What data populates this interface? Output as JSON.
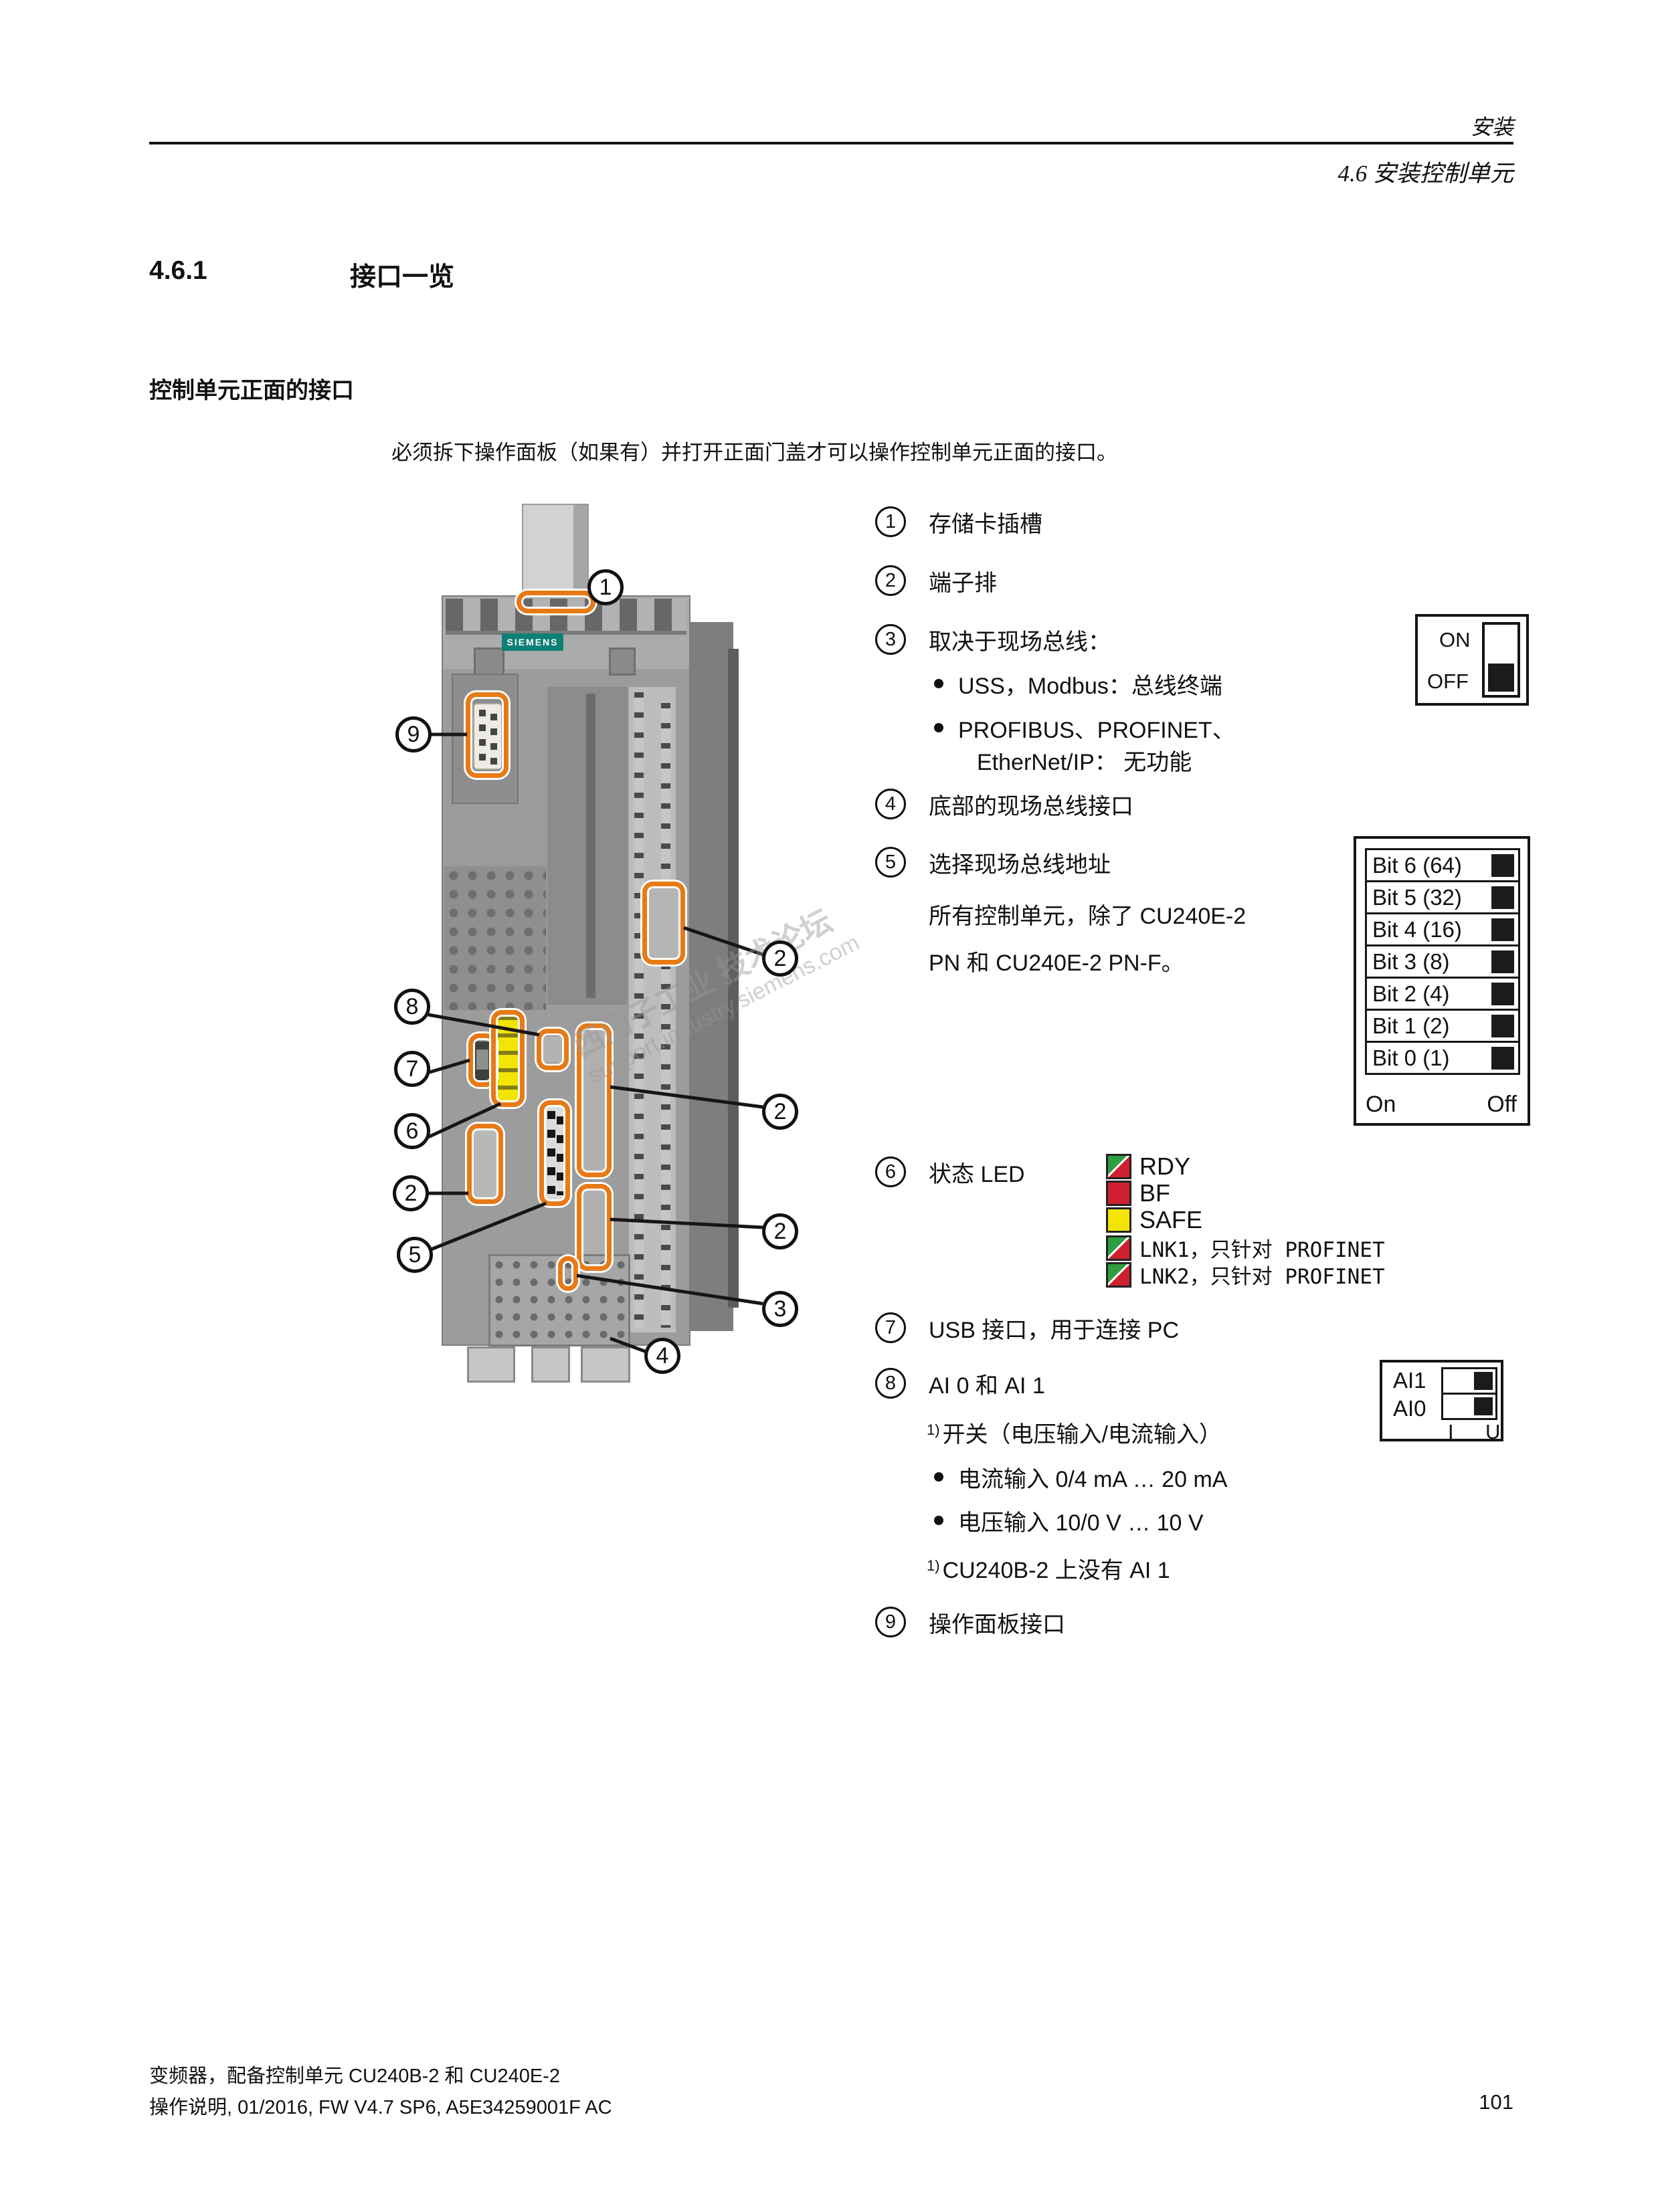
{
  "colors": {
    "accent_orange": "#e87a16",
    "siemens_teal": "#0d8074",
    "led_green": "#2f9e41",
    "led_red": "#cf2030",
    "led_yellow": "#f3e404"
  },
  "header": {
    "chapter": "安装",
    "section": "4.6 安装控制单元"
  },
  "section": {
    "number": "4.6.1",
    "title": "接口一览",
    "subheading": "控制单元正面的接口",
    "intro": "必须拆下操作面板（如果有）并打开正面门盖才可以操作控制单元正面的接口。"
  },
  "list": {
    "items": [
      {
        "num": "1",
        "text": "存储卡插槽"
      },
      {
        "num": "2",
        "text": "端子排"
      },
      {
        "num": "3",
        "text": "取决于现场总线："
      },
      {
        "num": "4",
        "text": "底部的现场总线接口"
      },
      {
        "num": "5",
        "text": "选择现场总线地址"
      },
      {
        "num": "6",
        "text": "状态 LED"
      },
      {
        "num": "7",
        "text": "USB 接口，用于连接 PC"
      },
      {
        "num": "8",
        "text": "AI 0 和 AI 1"
      },
      {
        "num": "9",
        "text": "操作面板接口"
      }
    ],
    "item3_bullet1": "USS，Modbus：总线终端",
    "item3_bullet2_line1": "PROFIBUS、PROFINET、",
    "item3_bullet2_line2": "EtherNet/IP： 无功能",
    "item5_note_line1": "所有控制单元，除了 CU240E-2",
    "item5_note_line2": "PN 和 CU240E-2 PN-F。",
    "item8_sup": "1)",
    "item8_text": "开关（电压输入/电流输入）",
    "item8_bullet1": "电流输入 0/4 mA … 20 mA",
    "item8_bullet2": "电压输入 10/0 V … 10 V",
    "footnote_sup": "1)",
    "footnote_text": "CU240B-2 上没有 AI 1"
  },
  "onoff": {
    "on": "ON",
    "off": "OFF"
  },
  "bits": {
    "rows": [
      "Bit 6 (64)",
      "Bit 5 (32)",
      "Bit 4 (16)",
      "Bit 3 (8)",
      "Bit 2 (4)",
      "Bit 1 (2)",
      "Bit 0 (1)"
    ],
    "on": "On",
    "off": "Off"
  },
  "leds": {
    "items": [
      {
        "label": "RDY"
      },
      {
        "label": "BF"
      },
      {
        "label": "SAFE"
      },
      {
        "label": "LNK1，只针对 PROFINET"
      },
      {
        "label": "LNK2，只针对 PROFINET"
      }
    ]
  },
  "ai": {
    "row1": "AI1",
    "row2": "AI0",
    "col_i": "I",
    "col_u": "U"
  },
  "device": {
    "brand": "SIEMENS",
    "callouts": [
      "1",
      "9",
      "8",
      "7",
      "6",
      "2",
      "5",
      "2",
      "2",
      "2",
      "3",
      "4"
    ],
    "watermark_line1": "西门子工业 技术论坛",
    "watermark_line2": "support.industry.siemens.com"
  },
  "footer": {
    "line1": "变频器，配备控制单元 CU240B-2 和 CU240E-2",
    "line2": "操作说明, 01/2016, FW V4.7 SP6, A5E34259001F AC",
    "page": "101"
  }
}
